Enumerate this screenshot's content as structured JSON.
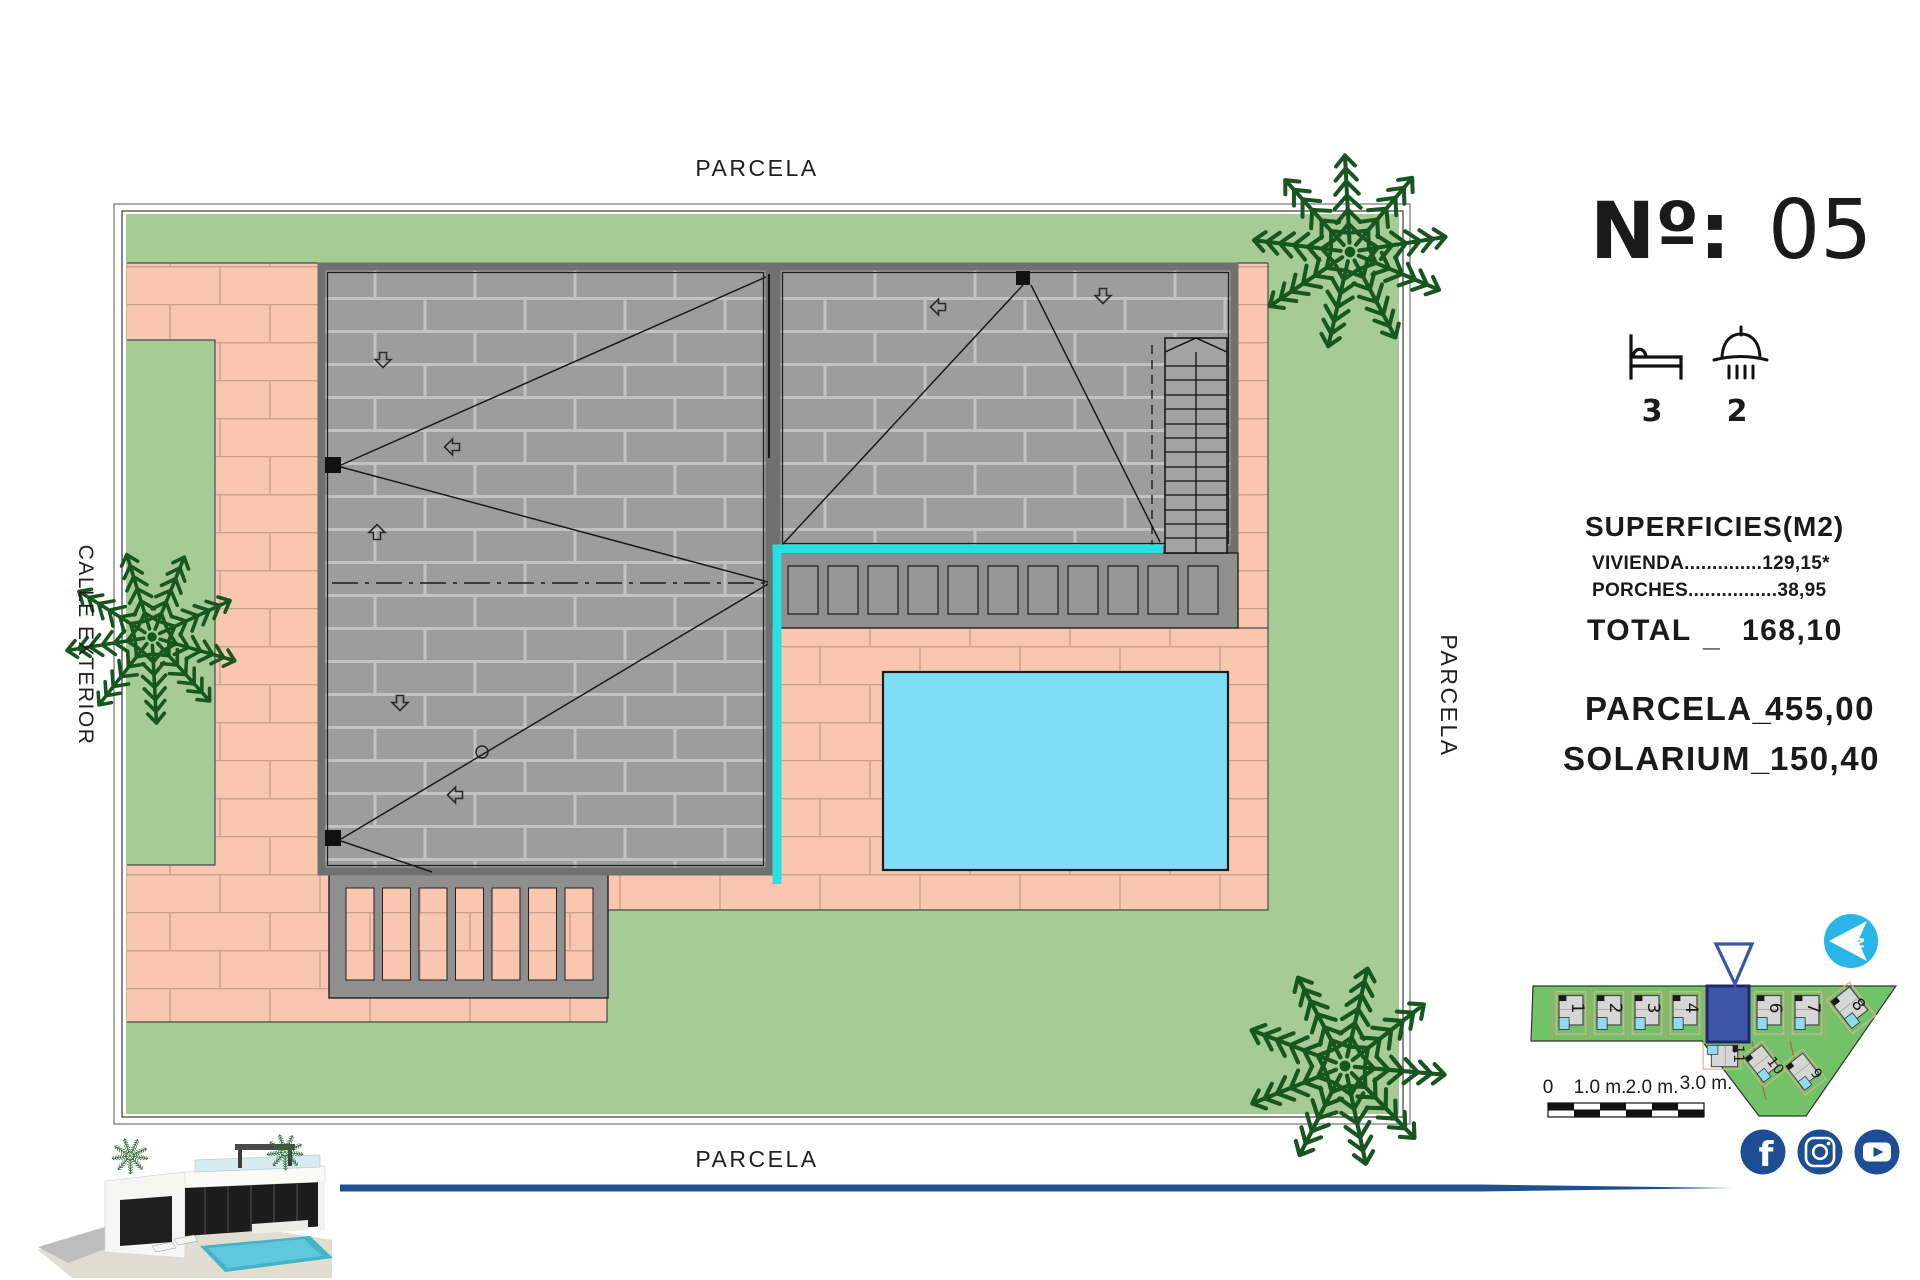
{
  "sheet": {
    "plot_number_label": "Nº:",
    "plot_number": "05",
    "bedrooms": "3",
    "bathrooms": "2"
  },
  "site_labels": {
    "top": "PARCELA",
    "bottom": "PARCELA",
    "right": "PARCELA",
    "left": "CALLE EXTERIOR"
  },
  "surfaces": {
    "title": "SUPERFICIES(M2)",
    "vivienda": "VIVIENDA..............129,15*",
    "porches": "PORCHES................38,95",
    "total_label": "TOTAL",
    "total_sep": "_",
    "total_value": "168,10",
    "parcela_label": "PARCELA_",
    "parcela_value": "455,00",
    "solarium_label": "SOLARIUM_",
    "solarium_value": "150,40"
  },
  "minimap": {
    "plots": [
      "1",
      "2",
      "3",
      "4",
      "6",
      "7",
      "8",
      "11",
      "10",
      "9"
    ]
  },
  "scalebar": {
    "labels": [
      "0",
      "1.0 m.",
      "2.0 m.",
      "3.0 m."
    ]
  },
  "compass": {
    "north": "N"
  },
  "colors": {
    "grass": "#a6cb94",
    "paving": "#f9c7af",
    "roof": "#9d9d9d",
    "pool": "#7eddf8",
    "cyan_edge": "#2adfdf",
    "accent_navy": "#1d4f91",
    "social_navy": "#1d4e94",
    "compass_cyan": "#2ab5e8",
    "minimap_green": "#72c268",
    "highlight_blue": "#3f55a8"
  }
}
